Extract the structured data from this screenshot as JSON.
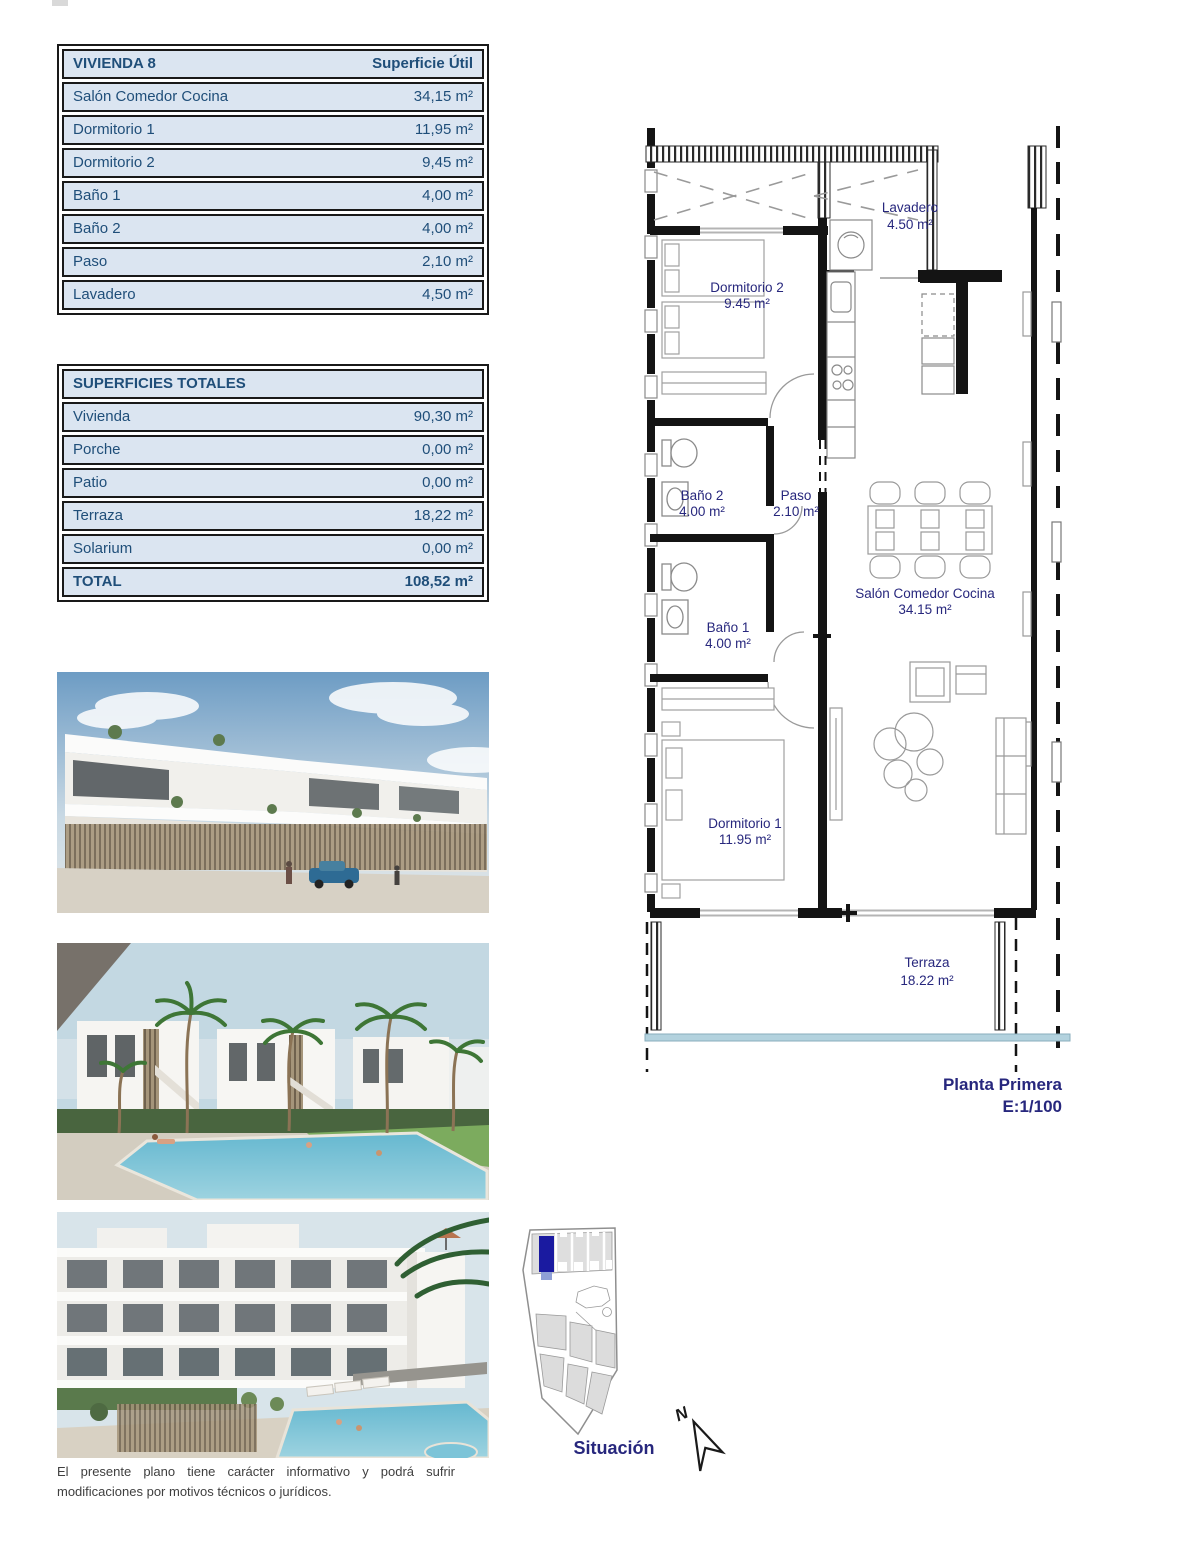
{
  "tables": {
    "vivienda": {
      "title": "VIVIENDA 8",
      "header_right": "Superficie Útil",
      "rows": [
        {
          "label": "Salón Comedor Cocina",
          "value": "34,15 m²"
        },
        {
          "label": "Dormitorio 1",
          "value": "11,95 m²"
        },
        {
          "label": "Dormitorio 2",
          "value": "9,45 m²"
        },
        {
          "label": "Baño 1",
          "value": "4,00 m²"
        },
        {
          "label": "Baño 2",
          "value": "4,00 m²"
        },
        {
          "label": "Paso",
          "value": "2,10 m²"
        },
        {
          "label": "Lavadero",
          "value": "4,50 m²"
        }
      ]
    },
    "totales": {
      "title": "SUPERFICIES TOTALES",
      "rows": [
        {
          "label": "Vivienda",
          "value": "90,30 m²"
        },
        {
          "label": "Porche",
          "value": "0,00 m²"
        },
        {
          "label": "Patio",
          "value": "0,00 m²"
        },
        {
          "label": "Terraza",
          "value": "18,22 m²"
        },
        {
          "label": "Solarium",
          "value": "0,00 m²"
        }
      ],
      "total": {
        "label": "TOTAL",
        "value": "108,52 m²"
      }
    }
  },
  "floor_plan": {
    "rooms": [
      {
        "name": "Lavadero",
        "area": "4.50 m²"
      },
      {
        "name": "Dormitorio 2",
        "area": "9.45 m²"
      },
      {
        "name": "Baño 2",
        "area": "4.00 m²"
      },
      {
        "name": "Paso",
        "area": "2.10 m²"
      },
      {
        "name": "Salón Comedor Cocina",
        "area": "34.15 m²"
      },
      {
        "name": "Baño 1",
        "area": "4.00 m²"
      },
      {
        "name": "Dormitorio 1",
        "area": "11.95 m²"
      },
      {
        "name": "Terraza",
        "area": "18.22 m²"
      }
    ],
    "plan_title": "Planta Primera",
    "plan_scale": "E:1/100"
  },
  "site_map": {
    "label": "Situación",
    "north": "N"
  },
  "photos": [
    {
      "name": "street-render"
    },
    {
      "name": "pool-render"
    },
    {
      "name": "apartments-pool-render"
    }
  ],
  "disclaimer": "El presente plano tiene carácter informativo y podrá sufrir modificaciones por motivos técnicos o jurídicos.",
  "colors": {
    "table_fill": "#dbe5f1",
    "table_text": "#1f4e79",
    "plan_label": "#27277d",
    "highlight_blue": "#1a1aa0",
    "water_line": "#b3d2de"
  }
}
